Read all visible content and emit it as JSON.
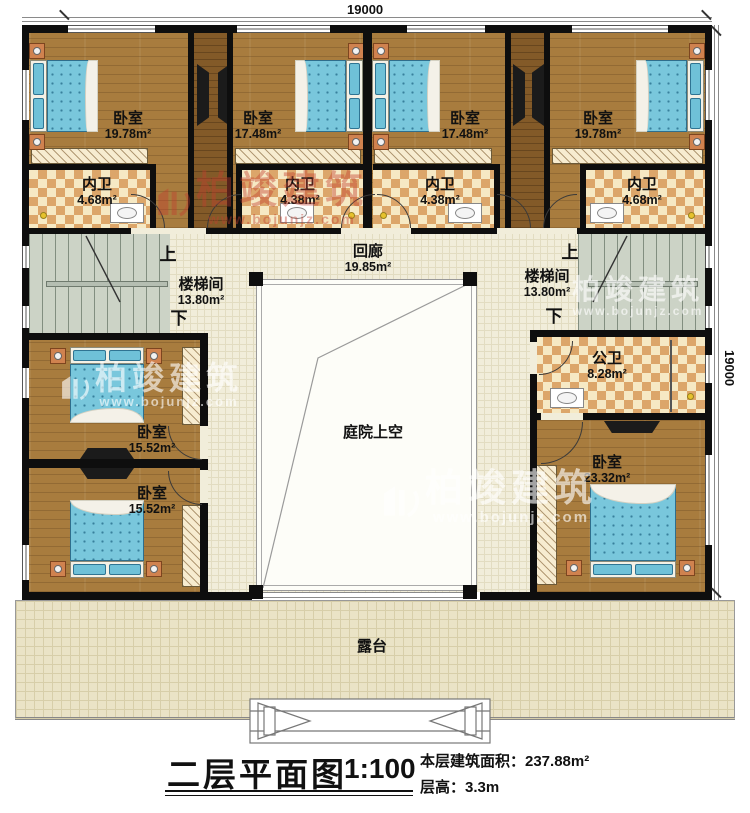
{
  "dimensions": {
    "top": "19000",
    "right": "19000"
  },
  "rooms": {
    "bedroom_tl": {
      "name": "卧室",
      "area": "19.78m²"
    },
    "bedroom_tml": {
      "name": "卧室",
      "area": "17.48m²"
    },
    "bedroom_tmr": {
      "name": "卧室",
      "area": "17.48m²"
    },
    "bedroom_tr": {
      "name": "卧室",
      "area": "19.78m²"
    },
    "ensuite_1": {
      "name": "内卫",
      "area": "4.68m²"
    },
    "ensuite_2": {
      "name": "内卫",
      "area": "4.38m²"
    },
    "ensuite_3": {
      "name": "内卫",
      "area": "4.38m²"
    },
    "ensuite_4": {
      "name": "内卫",
      "area": "4.68m²"
    },
    "stair_left": {
      "name": "楼梯间",
      "area": "13.80m²",
      "up": "上",
      "down": "下"
    },
    "stair_right": {
      "name": "楼梯间",
      "area": "13.80m²",
      "up": "上",
      "down": "下"
    },
    "corridor": {
      "name": "回廊",
      "area": "19.85m²"
    },
    "courtyard": {
      "name": "庭院上空"
    },
    "bedroom_ml": {
      "name": "卧室",
      "area": "15.52m²"
    },
    "bedroom_bl": {
      "name": "卧室",
      "area": "15.52m²"
    },
    "public_bath": {
      "name": "公卫",
      "area": "8.28m²"
    },
    "bedroom_br": {
      "name": "卧室",
      "area": "23.32m²"
    },
    "terrace": {
      "name": "露台"
    }
  },
  "title_block": {
    "title": "二层平面图",
    "scale": "1:100",
    "area_line": "本层建筑面积：237.88m²",
    "height_line": "层高：3.3m"
  },
  "watermark": {
    "brand": "柏竣建筑",
    "url": "www.bojunjz.com"
  },
  "colors": {
    "wall": "#0e0e0e",
    "wood": "#a87c3e",
    "tile": "#dca66a",
    "stair": "#ccd3c6",
    "bed": "#79c7dc",
    "terrace": "#eae3c6"
  }
}
